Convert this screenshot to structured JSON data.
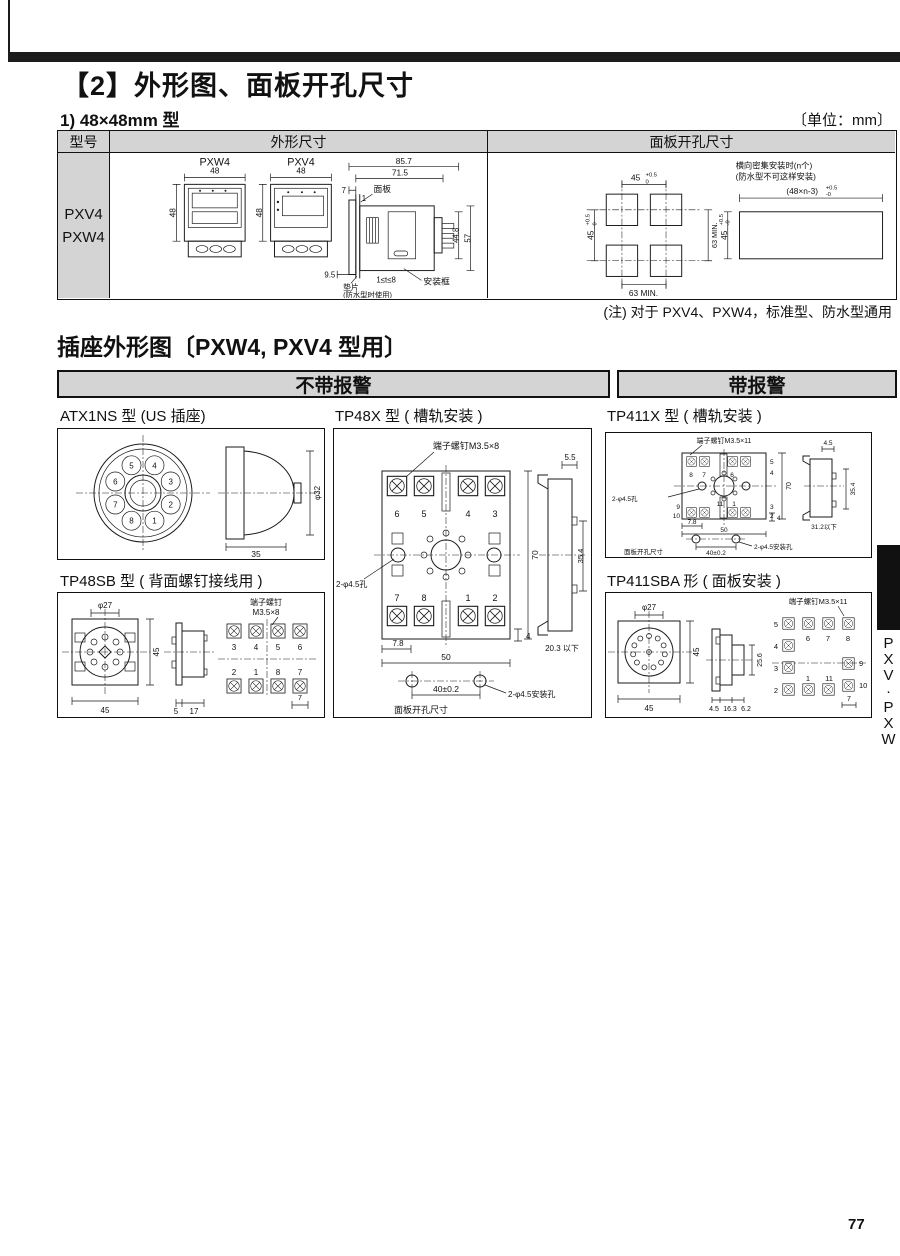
{
  "page": {
    "title": "【2】外形图、面板开孔尺寸",
    "subtitle": "1) 48×48mm 型",
    "unit": "〔单位：mm〕",
    "note": "(注) 对于 PXV4、PXW4，标准型、防水型通用",
    "page_number": "77",
    "side_tab_letters": [
      "P",
      "X",
      "V",
      "·",
      "P",
      "X",
      "W"
    ]
  },
  "table": {
    "col_model": "型号",
    "col_outline": "外形尺寸",
    "col_cutout": "面板开孔尺寸",
    "models": [
      "PXV4",
      "PXW4"
    ]
  },
  "outline": {
    "pxw4": "PXW4",
    "pxv4": "PXV4",
    "w48a": "48",
    "h48a": "48",
    "w48b": "48",
    "h48b": "48",
    "d857": "85.7",
    "d715": "71.5",
    "d7": "7",
    "d1": "1",
    "panel": "面板",
    "d448": "44.8",
    "d57": "57",
    "d95": "9.5",
    "t_range": "1≤t≤8",
    "frame": "安装框",
    "gasket": "垫片",
    "gasket_note": "(防水型时使用)"
  },
  "cutout": {
    "w45": "45",
    "tol_p": "+0.5",
    "tol_0": "0",
    "h45": "45",
    "htol_p": "+0.5",
    "htol_0": "0",
    "min63v": "63 MIN.",
    "min63h": "63 MIN.",
    "dense1": "横向密集安装时(n个)",
    "dense2": "(防水型不可这样安装)",
    "dense_w": "(48×n-3)",
    "dense_tp": "+0.5",
    "dense_t0": "-0",
    "dense_h": "45",
    "dense_hp": "+0.5",
    "dense_h0": "-0"
  },
  "sockets": {
    "title": "插座外形图〔PXW4, PXV4 型用〕",
    "no_alarm": "不带报警",
    "alarm": "带报警",
    "atx1ns": {
      "title": "ATX1NS 型 (US 插座)",
      "pins": [
        "5",
        "4",
        "6",
        "3",
        "7",
        "2",
        "8",
        "1"
      ],
      "dia": "φ32",
      "depth": "35"
    },
    "tp48x": {
      "title": "TP48X 型 ( 槽轨安装 )",
      "screw": "端子螺钉M3.5×8",
      "hole": "2-φ4.5孔",
      "top_nums": [
        "6",
        "5",
        "4",
        "3"
      ],
      "bot_nums": [
        "7",
        "8",
        "1",
        "2"
      ],
      "h70": "70",
      "d78": "7.8",
      "w50": "50",
      "d4": "4",
      "s55": "5.5",
      "s354": "35.4",
      "s203": "20.3 以下",
      "pitch": "40±0.2",
      "mhole": "2-φ4.5安装孔",
      "cutout_label": "面板开孔尺寸"
    },
    "tp411x": {
      "title": "TP411X 型 ( 槽轨安装 )",
      "screw": "端子螺钉M3.5×11",
      "hole": "2-φ4.5孔",
      "n8": "8",
      "n7": "7",
      "n6": "6",
      "n5": "5",
      "n4": "4",
      "n3": "3",
      "n2": "2",
      "n9": "9",
      "n10": "10",
      "n11": "11",
      "n1": "1",
      "h70": "70",
      "d78": "7.8",
      "w50": "50",
      "d4": "4",
      "s45": "4.5",
      "s354": "35.4",
      "s312": "31.2以下",
      "pitch": "40±0.2",
      "mhole": "2-φ4.5安装孔",
      "cutout_label": "面板开孔尺寸"
    },
    "tp48sb": {
      "title": "TP48SB 型 ( 背面螺钉接线用 )",
      "dia": "φ27",
      "h45": "45",
      "w45": "45",
      "s5": "5",
      "s17": "17",
      "screw1": "端子螺钉",
      "screw2": "M3.5×8",
      "top_nums": [
        "3",
        "4",
        "5",
        "6"
      ],
      "bot_nums": [
        "2",
        "1",
        "8",
        "7"
      ],
      "pitch7": "7"
    },
    "tp411sba": {
      "title": "TP411SBA 形 ( 面板安装 )",
      "dia": "φ27",
      "h45": "45",
      "w45": "45",
      "s45": "4.5",
      "s163": "16.3",
      "s62": "6.2",
      "s256": "25.6",
      "screw": "端子螺钉M3.5×11",
      "left_nums": [
        "5",
        "4",
        "3",
        "2"
      ],
      "top_nums": [
        "6",
        "7",
        "8"
      ],
      "right_nums": [
        "9",
        "10"
      ],
      "bot_nums": [
        "1",
        "11"
      ],
      "pitch7": "7"
    }
  }
}
